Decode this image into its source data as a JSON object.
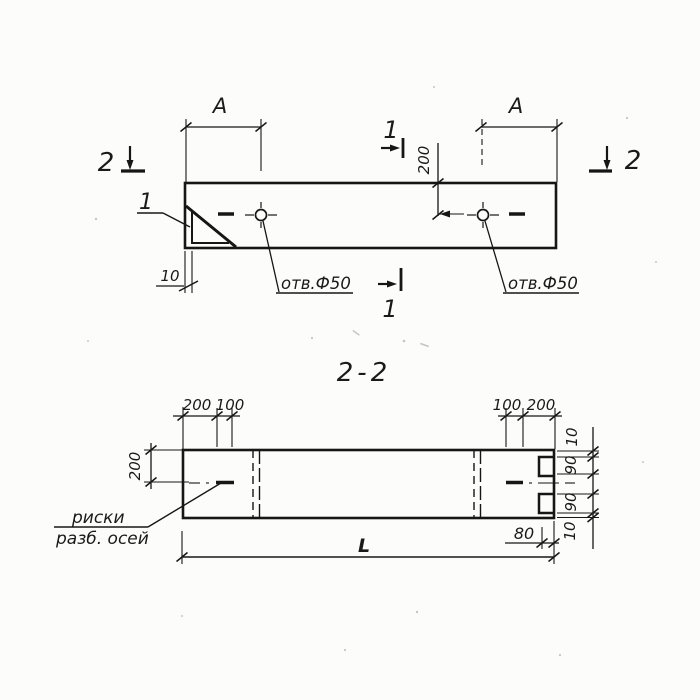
{
  "drawing": {
    "title_section": "2-2",
    "plan": {
      "section_marker_left": "2",
      "section_marker_right": "2",
      "section_marker_top": "1",
      "section_marker_bottom": "1",
      "dim_a_left": "A",
      "dim_a_right": "A",
      "dim_hole_offset": "200",
      "dim_edge": "10",
      "detail_callout": "1",
      "hole_label_left": "отв.Ф50",
      "hole_label_right": "отв.Ф50"
    },
    "section": {
      "dim_top_left_1": "200",
      "dim_top_left_2": "100",
      "dim_top_right_1": "100",
      "dim_top_right_2": "200",
      "dim_left_depth": "200",
      "dim_right_chain": [
        "10",
        "90",
        "90",
        "10"
      ],
      "dim_length": "L",
      "dim_notch_depth": "80",
      "note_line1": "риски",
      "note_line2": "разб. осей"
    },
    "colors": {
      "ink": "#161616",
      "paper": "#fcfcfa"
    }
  }
}
